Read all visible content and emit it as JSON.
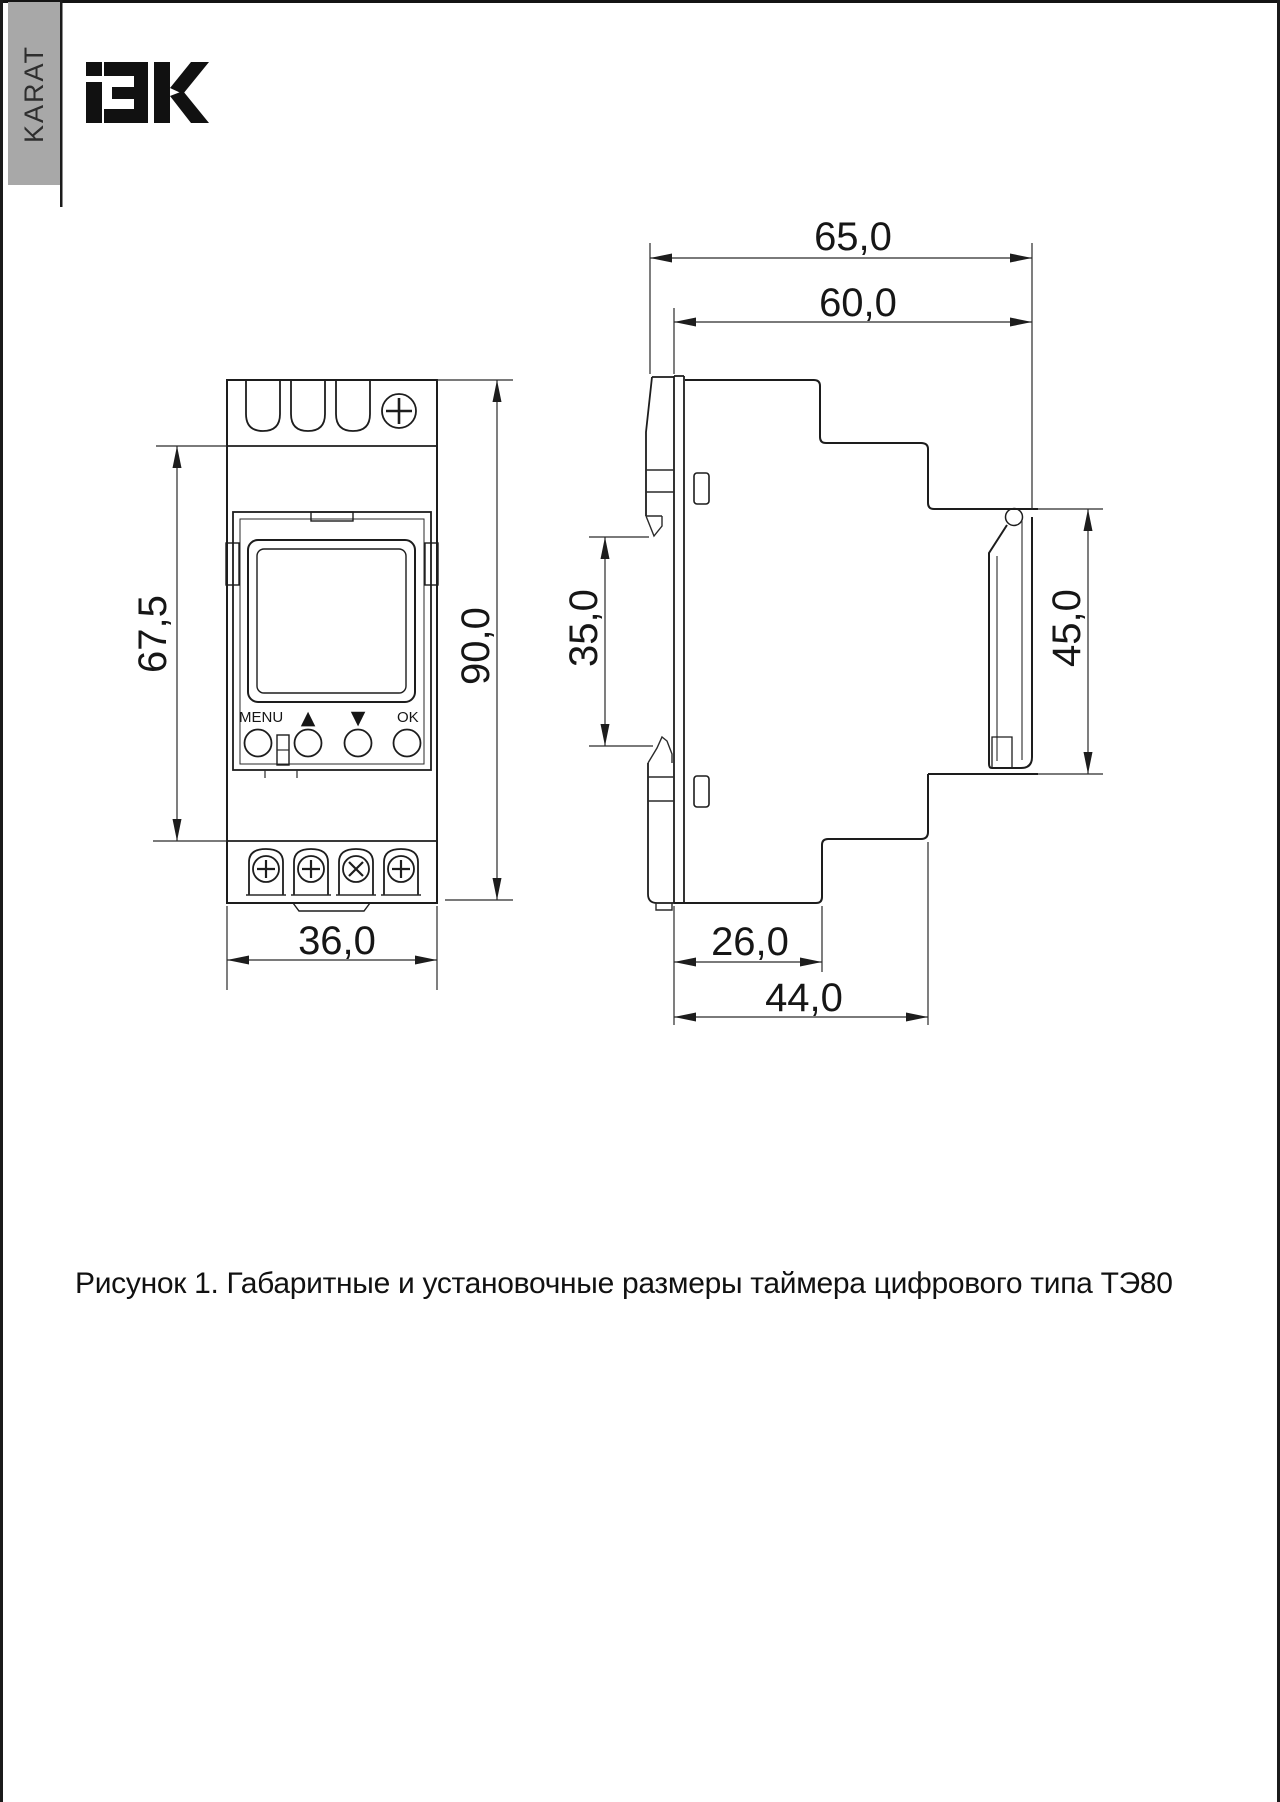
{
  "page": {
    "background": "#ffffff",
    "line_color": "#1d1d1d",
    "sidebar": {
      "label": "KARAT",
      "bg": "#a8a8a8"
    },
    "logo": {
      "text": "IEK",
      "color": "#111111"
    }
  },
  "figure": {
    "caption": "Рисунок 1. Габаритные и установочные размеры таймера цифрового типа ТЭ80"
  },
  "front_view": {
    "buttons": {
      "menu": "MENU",
      "up": "▲",
      "down": "▼",
      "ok": "OK"
    },
    "dims": {
      "upper_height": "67,5",
      "total_height": "90,0",
      "width": "36,0"
    }
  },
  "side_view": {
    "dims": {
      "total_width": "65,0",
      "body_width": "60,0",
      "din_gap": "35,0",
      "front_height": "45,0",
      "lower_depth": "26,0",
      "total_depth": "44,0"
    }
  }
}
